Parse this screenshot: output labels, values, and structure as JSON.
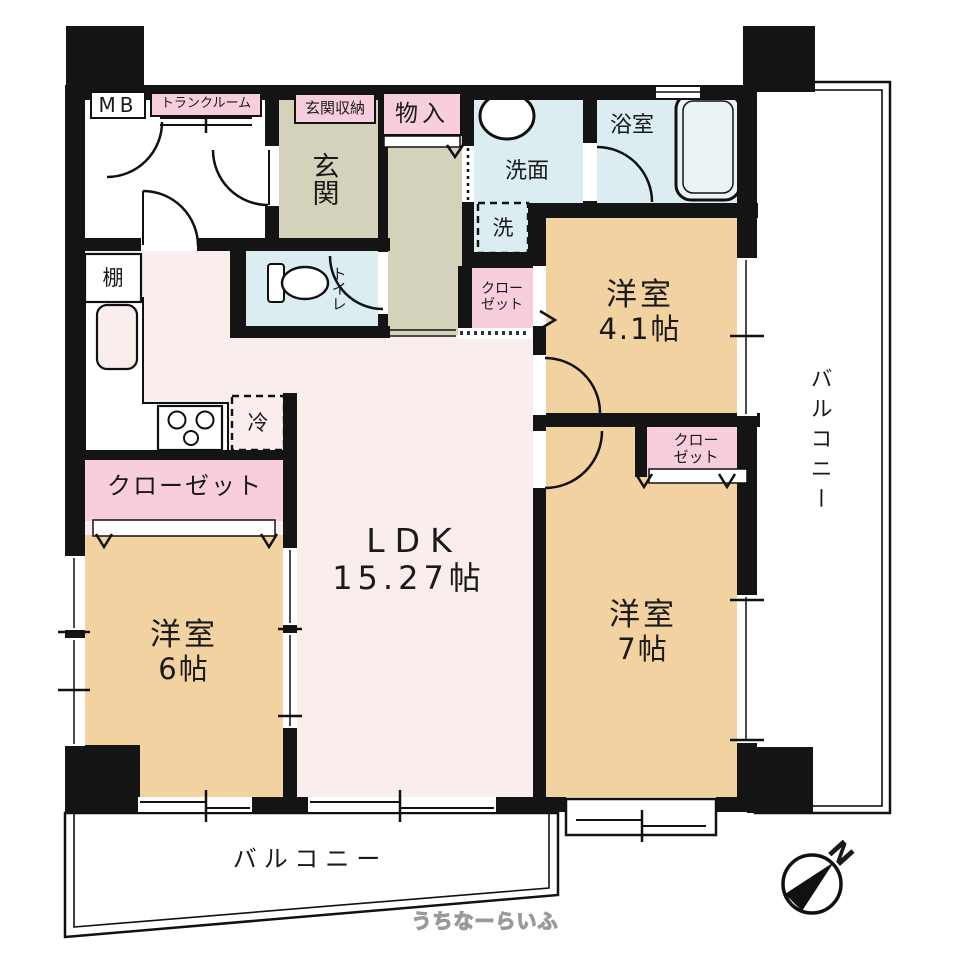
{
  "colors": {
    "wall": "#141414",
    "room": "#f1d2a0",
    "ldk_floor": "#faeeec",
    "entrance_floor": "#d5d2bb",
    "wet_floor": "#dcedf1",
    "closet_pink": "#f8cedd",
    "balcony": "#ffffff",
    "tub_fill": "#eaf4f7"
  },
  "labels": {
    "meter_box": "MB",
    "trunk_room": "トランクルーム",
    "entrance_storage": "玄関収納",
    "entrance": "玄関",
    "storage": "物入",
    "washroom": "洗面",
    "washing_machine": "洗",
    "bathroom": "浴室",
    "toilet": "トイレ",
    "shelf": "棚",
    "refrigerator": "冷",
    "closet": "クローゼット",
    "closet_line1": "クロー",
    "closet_line2": "ゼット",
    "balcony": "バルコニー",
    "north": "N",
    "watermark": "うちなーらいふ"
  },
  "rooms": {
    "ldk": {
      "name": "LDK",
      "size": "15.27帖"
    },
    "western_room_a": {
      "name": "洋室",
      "size": "4.1帖"
    },
    "western_room_b": {
      "name": "洋室",
      "size": "7帖"
    },
    "western_room_c": {
      "name": "洋室",
      "size": "6帖"
    }
  }
}
